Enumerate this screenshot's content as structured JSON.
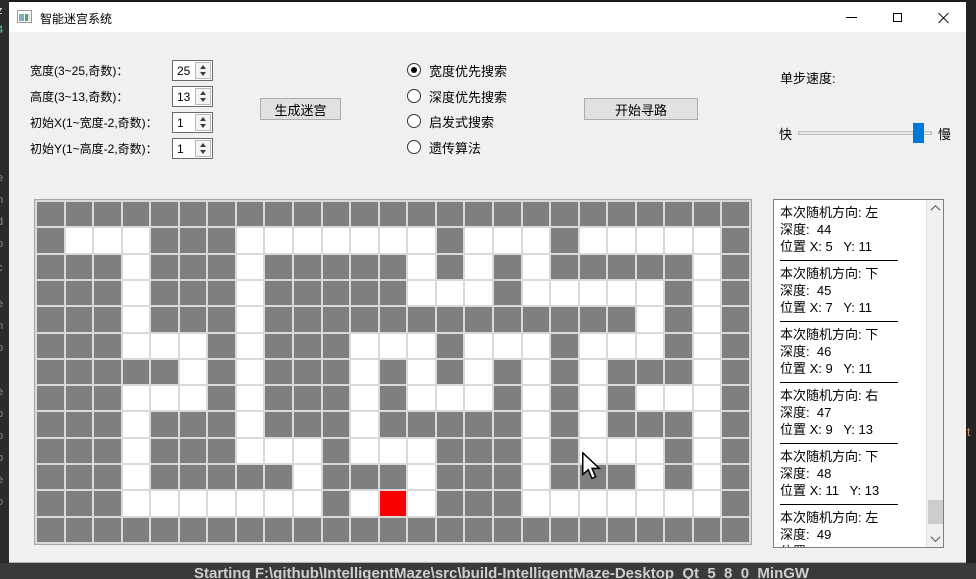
{
  "window": {
    "title": "智能迷宫系统"
  },
  "form": {
    "fields": [
      {
        "label": "宽度(3~25,奇数)：",
        "value": "25"
      },
      {
        "label": "高度(3~13,奇数)：",
        "value": "13"
      },
      {
        "label": "初始X(1~宽度-2,奇数)：",
        "value": "1"
      },
      {
        "label": "初始Y(1~高度-2,奇数)：",
        "value": "1"
      }
    ],
    "generate_button": "生成迷宫"
  },
  "search": {
    "options": [
      {
        "label": "宽度优先搜索",
        "selected": true
      },
      {
        "label": "深度优先搜索",
        "selected": false
      },
      {
        "label": "启发式搜索",
        "selected": false
      },
      {
        "label": "遗传算法",
        "selected": false
      }
    ],
    "start_button": "开始寻路"
  },
  "speed": {
    "label": "单步速度:",
    "fast_label": "快",
    "slow_label": "慢",
    "handle_color": "#0078d7",
    "position_pct": 94
  },
  "maze": {
    "cols": 25,
    "rows": 13,
    "wall_color": "#7f7f7f",
    "path_color": "#ffffff",
    "marker_color": "#fb0000",
    "grid": [
      "WWWWWWWWWWWWWWWWWWWWWWWWW",
      "WPPPWWWPPPPPPPWPPPWPPPPPW",
      "WWWPWWWPWWWWWPWPWPWWWWWPW",
      "WWWPWWWPWWWWWPPPWPPPPPWPW",
      "WWWPWWWPWWWWWWWWWWWWWPWPW",
      "WWWPPPWPWWWPPPWPPPWPPPWPW",
      "WWWWWPWPWWWPWPWPWPWPWWWPW",
      "WWWPPPWPWWWPWPPPWPWPWPPPW",
      "WWWPWWWPWWWPWWWWWPWPWWWPW",
      "WWWPWWWPPPWPPPWWWPWPPPWPW",
      "WWWPWWWWWPWWWPWWWPWWWPWPW",
      "WWWPPPPPPPWPRPWWWPPPPPPPW",
      "WWWWWWWWWWWWWWWWWWWWWWWWW"
    ]
  },
  "log": {
    "entries": [
      {
        "direction": "本次随机方向: 左",
        "depth": "深度:  44",
        "position": "位置 X: 5   Y: 11"
      },
      {
        "direction": "本次随机方向: 下",
        "depth": "深度:  45",
        "position": "位置 X: 7   Y: 11"
      },
      {
        "direction": "本次随机方向: 下",
        "depth": "深度:  46",
        "position": "位置 X: 9   Y: 11"
      },
      {
        "direction": "本次随机方向: 右",
        "depth": "深度:  47",
        "position": "位置 X: 9   Y: 13"
      },
      {
        "direction": "本次随机方向: 下",
        "depth": "深度:  48",
        "position": "位置 X: 11   Y: 13"
      },
      {
        "direction": "本次随机方向: 左",
        "depth": "深度:  49",
        "position": "位置 X: 11   Y: 11"
      }
    ]
  },
  "background": {
    "console_text": "Starting F:\\github\\IntelligentMaze\\src\\build-IntelligentMaze-Desktop_Qt_5_8_0_MinGW",
    "left_edge_fragments": [
      {
        "ch": "z",
        "top": 5,
        "color": "#e2e2e2"
      },
      {
        "ch": "4",
        "top": 24,
        "color": "#4ec9b0"
      },
      {
        "ch": "e",
        "top": 172
      },
      {
        "ch": "n",
        "top": 194
      },
      {
        "ch": "d",
        "top": 216
      },
      {
        "ch": "o",
        "top": 238
      },
      {
        "ch": "c",
        "top": 262
      },
      {
        "ch": "e",
        "top": 298
      },
      {
        "ch": "n",
        "top": 320
      },
      {
        "ch": "o",
        "top": 342
      },
      {
        "ch": "e",
        "top": 386
      },
      {
        "ch": "p",
        "top": 408
      },
      {
        "ch": "o",
        "top": 430
      },
      {
        "ch": "p",
        "top": 452
      },
      {
        "ch": "e",
        "top": 474
      },
      {
        "ch": "o",
        "top": 496
      }
    ],
    "right_edge_fragment": {
      "ch": "t",
      "top": 425,
      "color": "#ce9178"
    }
  }
}
